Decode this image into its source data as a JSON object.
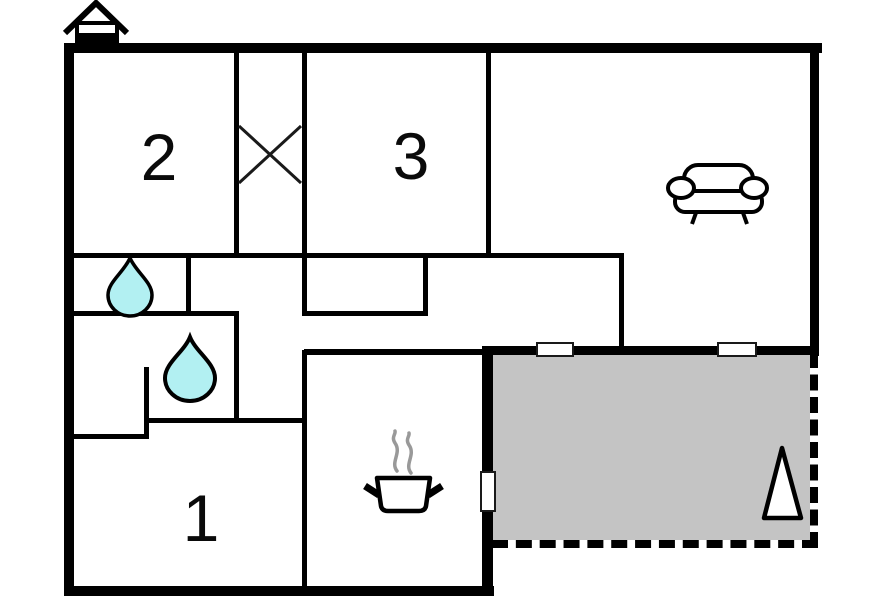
{
  "plan": {
    "type": "floor-plan",
    "rooms": [
      {
        "id": "room-1",
        "label": "1"
      },
      {
        "id": "room-2",
        "label": "2"
      },
      {
        "id": "room-3",
        "label": "3"
      }
    ],
    "icons": [
      {
        "name": "house-icon",
        "meaning": "ground floor indicator"
      },
      {
        "name": "stairs-cross-icon",
        "meaning": "crossed-out shaft between rooms 2 and 3"
      },
      {
        "name": "water-drop-icon",
        "meaning": "water / sanitary point (2 shown)"
      },
      {
        "name": "sofa-icon",
        "meaning": "living room seating"
      },
      {
        "name": "cooking-pot-icon",
        "meaning": "kitchen"
      },
      {
        "name": "terrace-cone-icon",
        "meaning": "marker on terrace"
      }
    ],
    "features": {
      "windows_on_terrace_wall": 2,
      "terrace_door": 1,
      "terrace": "gray area with dashed open edges"
    },
    "colors": {
      "wall": "#000000",
      "water_drop": "#b2f0f2",
      "terrace": "#c4c4c4",
      "steam": "#999999",
      "background": "#ffffff"
    }
  }
}
